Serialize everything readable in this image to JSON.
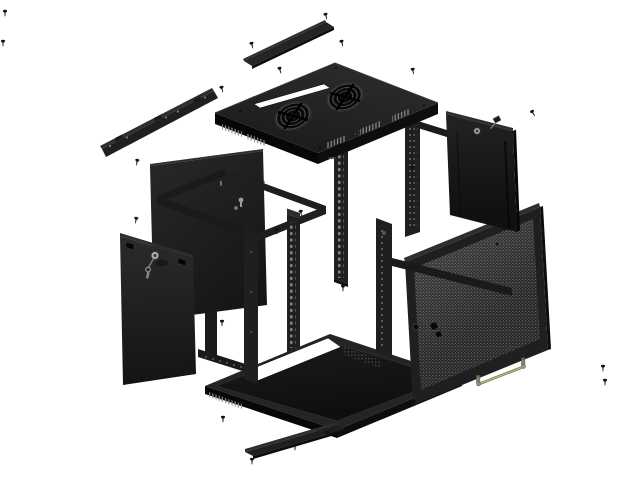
{
  "scene": {
    "description": "Exploded-view product illustration of a black wall-mount network server rack cabinet, isometric, on white background",
    "background": "#ffffff"
  },
  "palette": {
    "background": "#ffffff",
    "panel": "#1f1f1f",
    "panel2": "#242424",
    "panel_mid": "#1a1a1a",
    "panel_dark": "#0d0d0d",
    "panel_deep": "#070707",
    "panel_light": "#2e2e2e",
    "edge": "#3a3a3a",
    "hole": "#7a7a7a",
    "mesh_base": "#232323",
    "mesh_dot": "#606060",
    "metal": "#9a9a9a",
    "wire": "#b9bd8c",
    "screw": "#121212"
  },
  "components": [
    {
      "id": "top-cover-strip",
      "label": "top cover strip"
    },
    {
      "id": "wall-mount-bracket",
      "label": "wall mount bracket",
      "notches": 3,
      "holes": 5
    },
    {
      "id": "top-panel",
      "label": "top panel",
      "fan_grilles": 2,
      "has_cable_slot": true
    },
    {
      "id": "back-panel",
      "label": "back panel",
      "keyhole_mounts": 2
    },
    {
      "id": "frame",
      "label": "rack frame skeleton"
    },
    {
      "id": "rack-rails",
      "label": "cage-nut mounting rails",
      "count": 2
    },
    {
      "id": "left-side-panel",
      "label": "left side panel",
      "lock": true,
      "key": true
    },
    {
      "id": "right-side-panel",
      "label": "right side panel",
      "lock": true,
      "key": true
    },
    {
      "id": "mesh-door",
      "label": "perforated mesh front door",
      "lock": true,
      "knob": true
    },
    {
      "id": "bottom-panel",
      "label": "bottom tray panel",
      "has_cable_cutout": true,
      "vents": true
    },
    {
      "id": "bottom-cover-strip",
      "label": "bottom cover strip"
    },
    {
      "id": "grounding-wire",
      "label": "grounding wire with terminals"
    },
    {
      "id": "screws",
      "label": "mounting screws",
      "count": 23
    }
  ],
  "fans": {
    "count": 2,
    "centers": [
      [
        293,
        116
      ],
      [
        345,
        97
      ]
    ]
  },
  "screws": [
    [
      5,
      13,
      0
    ],
    [
      3,
      43,
      0
    ],
    [
      252,
      45,
      -15
    ],
    [
      326,
      16,
      -15
    ],
    [
      342,
      43,
      -15
    ],
    [
      280,
      70,
      -15
    ],
    [
      413,
      71,
      -10
    ],
    [
      222,
      89,
      -15
    ],
    [
      137,
      162,
      10
    ],
    [
      136,
      220,
      10
    ],
    [
      412,
      169,
      0
    ],
    [
      301,
      213,
      -10
    ],
    [
      277,
      231,
      0
    ],
    [
      343,
      288,
      0
    ],
    [
      222,
      323,
      0
    ],
    [
      223,
      419,
      0
    ],
    [
      252,
      461,
      0
    ],
    [
      295,
      447,
      0
    ],
    [
      327,
      434,
      0
    ],
    [
      414,
      403,
      0
    ],
    [
      533,
      113,
      -30
    ],
    [
      603,
      368,
      0
    ],
    [
      605,
      382,
      0
    ]
  ]
}
